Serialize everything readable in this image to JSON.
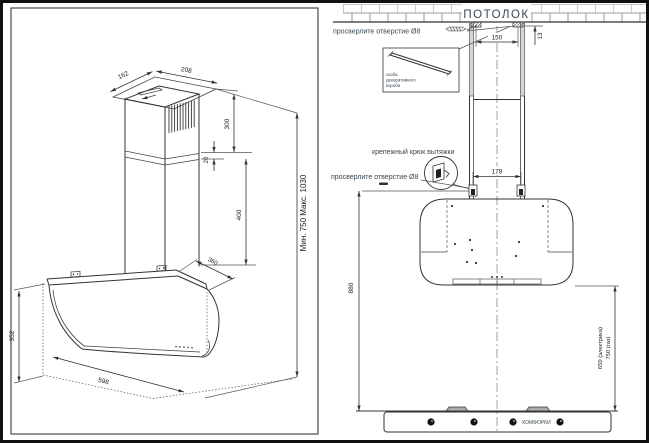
{
  "left_view": {
    "dims": {
      "duct_top_depth": "162",
      "duct_top_width": "208",
      "upper_duct_height": "300",
      "duct_overlap": "20",
      "lower_duct_height": "400",
      "hood_depth": "360",
      "hood_height": "352",
      "hood_width": "598",
      "total_height_range": "Мин. 750    Макс. 1030"
    }
  },
  "right_view": {
    "ceiling_label": "ПОТОЛОК",
    "drill_label_top": "просверлите отверстие Ø8",
    "drill_label_mid": "просверлите отверстие Ø8",
    "inset_label": [
      "скоба",
      "декоративного",
      "короба"
    ],
    "hook_label": "крепежный крюк вытяжки",
    "burners_label": "КОМФОРКИ",
    "dims": {
      "bracket_spacing": "150",
      "ceiling_offset": "13",
      "hook_spacing": "178",
      "hook_to_cooktop": "880",
      "hood_to_cooktop_electric": "650 (электрика)",
      "hood_to_cooktop_gas": "750 (газ)"
    }
  }
}
